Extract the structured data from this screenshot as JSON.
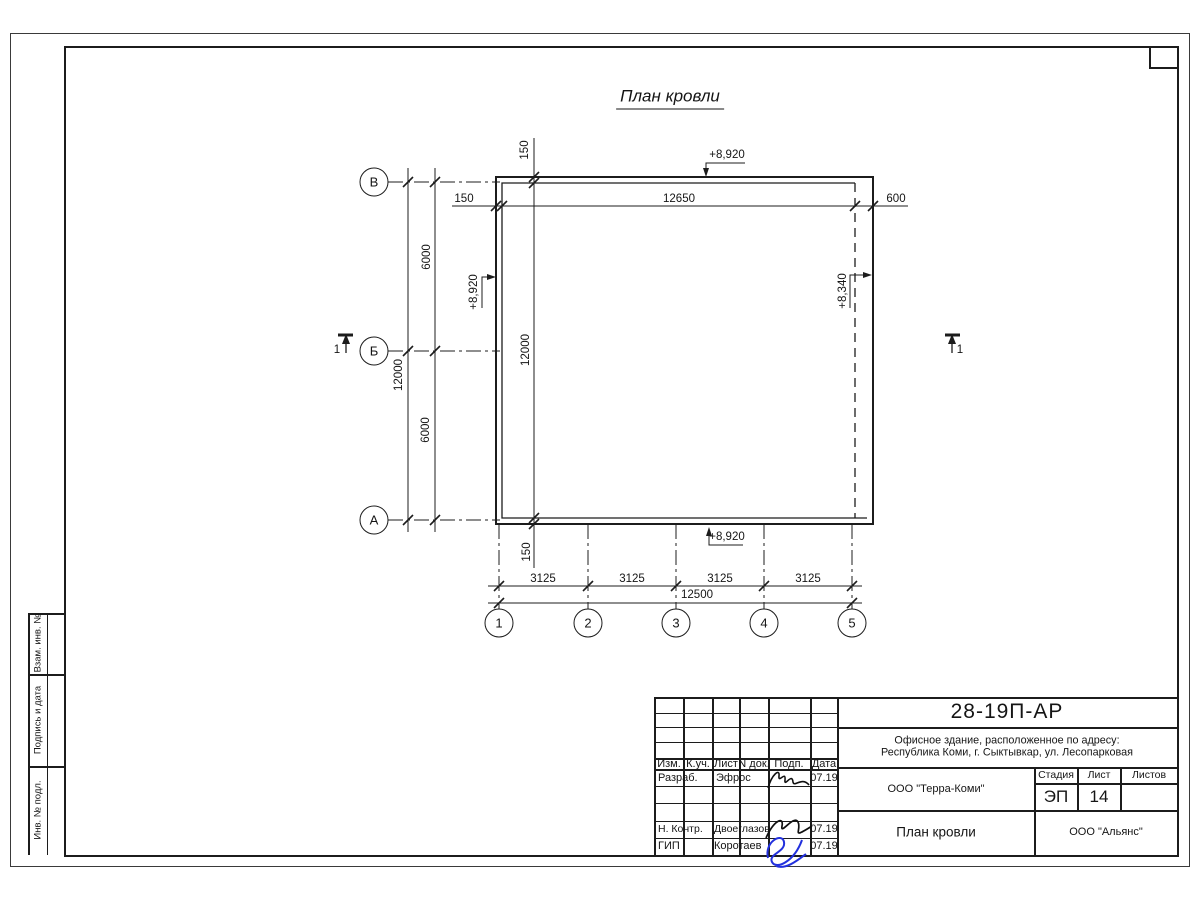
{
  "page": {
    "title": "План кровли"
  },
  "axes": {
    "rows": [
      "В",
      "Б",
      "А"
    ],
    "cols": [
      "1",
      "2",
      "3",
      "4",
      "5"
    ]
  },
  "dims": {
    "top": {
      "left": "150",
      "span": "12650",
      "right": "600"
    },
    "internal_vertical": {
      "top": "150",
      "span": "12000",
      "bottom": "150"
    },
    "row_spacing": [
      "6000",
      "6000"
    ],
    "row_total": "12000",
    "column_spacing": [
      "3125",
      "3125",
      "3125",
      "3125"
    ],
    "column_total": "12500"
  },
  "elevations": {
    "top": "+8,920",
    "left": "+8,920",
    "right": "+8,340",
    "bottom": "+8,920"
  },
  "section": {
    "label": "1"
  },
  "side_strip": {
    "labels": [
      "Взам. инв. №",
      "Подпись и дата",
      "Инв. № подл."
    ]
  },
  "stamp": {
    "doc_number": "28-19П-АР",
    "address_line1": "Офисное здание, расположенное по адресу:",
    "address_line2": "Республика Коми, г. Сыктывкар, ул. Лесопарковая",
    "header_cols": [
      "Изм.",
      "К.уч.",
      "Лист",
      "N док.",
      "Подп.",
      "Дата"
    ],
    "rows": [
      {
        "role": "Разраб.",
        "name": "Эфрос",
        "date": "07.19"
      },
      {
        "role": "Н. Контр.",
        "name": "Двоеглазов",
        "date": "07.19"
      },
      {
        "role": "ГИП",
        "name": "Коротаев",
        "date": "07.19"
      }
    ],
    "org1": "ООО \"Терра-Коми\"",
    "stage_label": "Стадия",
    "sheet_label": "Лист",
    "sheets_label": "Листов",
    "stage": "ЭП",
    "sheet": "14",
    "drawing_title": "План кровли",
    "org2": "ООО \"Альянс\""
  }
}
